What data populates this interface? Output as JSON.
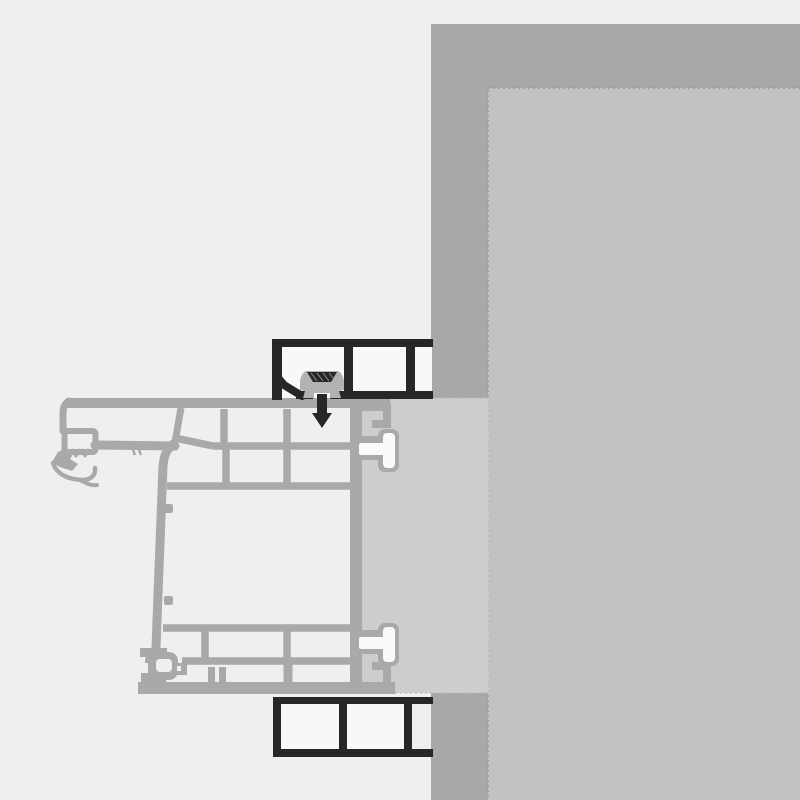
{
  "meta": {
    "type": "technical-cross-section",
    "description": "Horizontal installation cross-section detail of a multi-chamber PVC window frame profile fixed to a masonry wall with mounting box profiles, anchor clip and fixing screw",
    "title": "Window frame installation detail"
  },
  "colors": {
    "bg": "#efefef",
    "profile": "#a9a9a9",
    "panel": "#cdcdcd",
    "wall": "#a8a8a8",
    "wall_inner": "#c2c2c2",
    "cell": "#f8f8f8",
    "dark": "#272727",
    "clip": "#b2b2b2",
    "white": "#fafafa",
    "hatch": "#8f8f8f",
    "edge_dash": "#979797",
    "panel_dash": "#b3b3b3"
  },
  "parts": {
    "wall": "masonry wall section",
    "wall_inner_face": "interior wall reveal face",
    "installation_panel": "installation joint / plaster layer between frame and wall",
    "window_frame": "multi-chamber PVC window frame profile",
    "gasket": "flexible sealing gasket",
    "glazing_hook": "glazing bead retention hook",
    "anchor_lugs": "frame anchor lugs and T-connectors",
    "mounting_profile_top": "top mounting box profile (dark outline, two cells)",
    "mounting_profile_bottom": "bottom mounting box profile (dark outline, two cells)",
    "anchor_clip": "plastic fastening clip / dowel body",
    "screw": "countersunk fixing screw driven into frame"
  }
}
